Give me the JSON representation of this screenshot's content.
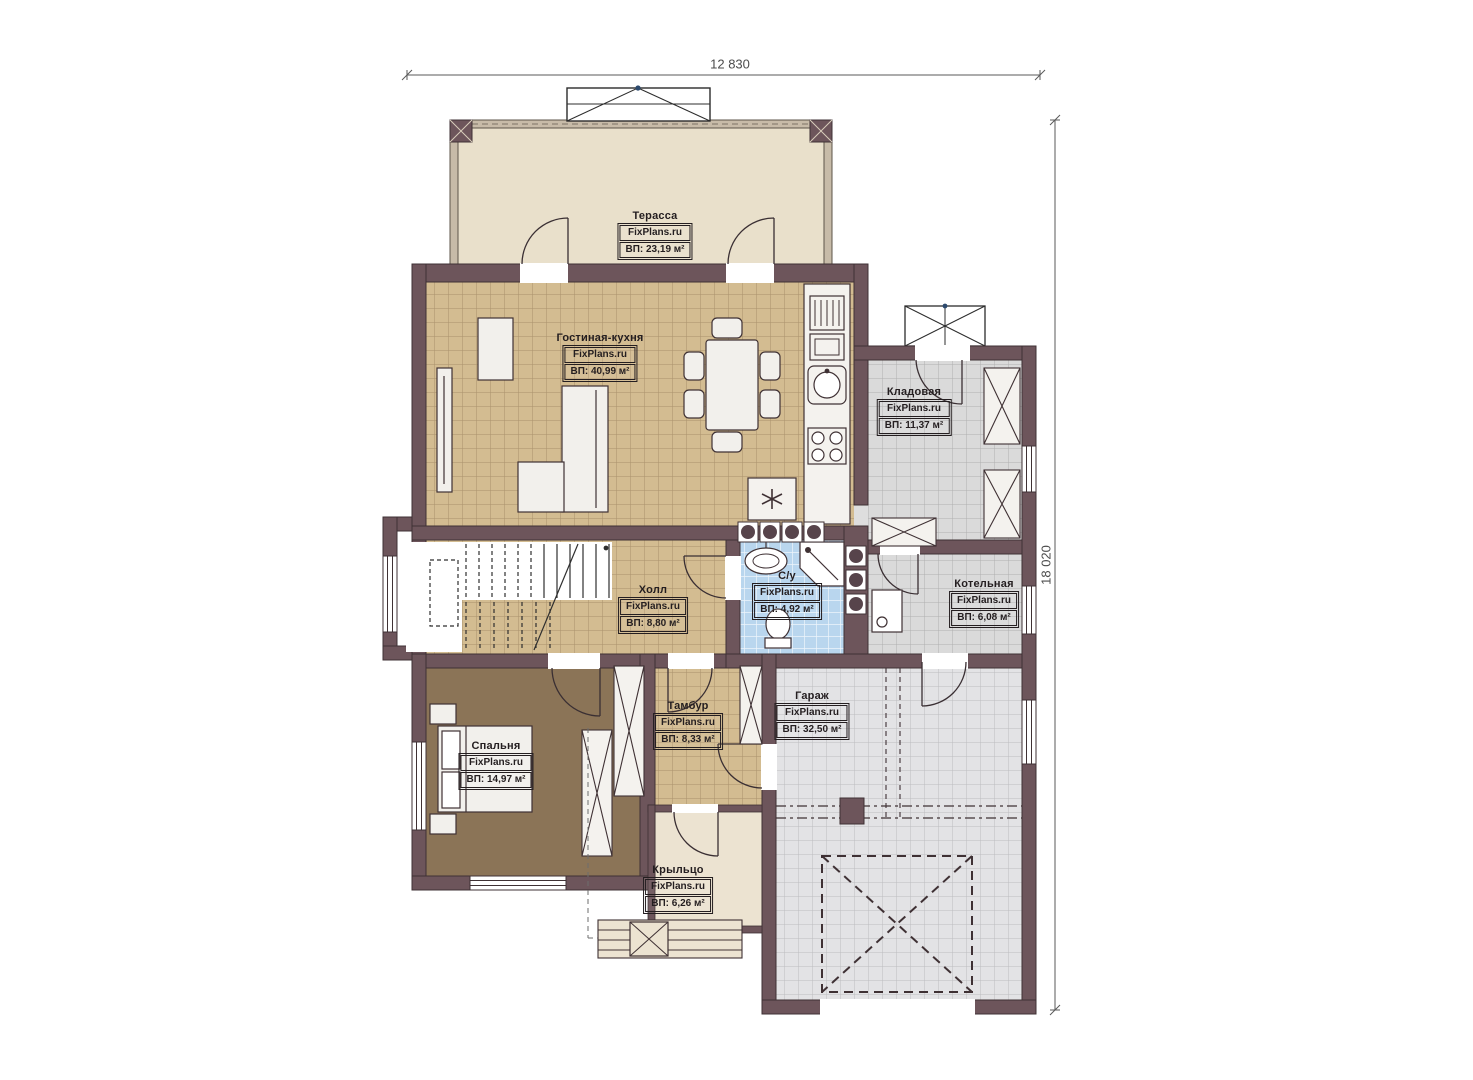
{
  "plan": {
    "type": "architectural-floor-plan",
    "overall_dimensions": {
      "width_mm": "12 830",
      "height_mm": "18 020"
    },
    "branding": {
      "site": "FixPlans.ru"
    },
    "rooms": [
      {
        "id": "terrace",
        "name": "Терасса",
        "brand": "FixPlans.ru",
        "area": "ВП: 23,19 м²"
      },
      {
        "id": "living-kitchen",
        "name": "Гостиная-кухня",
        "brand": "FixPlans.ru",
        "area": "ВП: 40,99 м²"
      },
      {
        "id": "storage",
        "name": "Кладовая",
        "brand": "FixPlans.ru",
        "area": "ВП: 11,37 м²"
      },
      {
        "id": "hall",
        "name": "Холл",
        "brand": "FixPlans.ru",
        "area": "ВП: 8,80 м²"
      },
      {
        "id": "bathroom",
        "name": "С/у",
        "brand": "FixPlans.ru",
        "area": "ВП: 4,92 м²"
      },
      {
        "id": "boiler",
        "name": "Котельная",
        "brand": "FixPlans.ru",
        "area": "ВП: 6,08 м²"
      },
      {
        "id": "vestibule",
        "name": "Тамбур",
        "brand": "FixPlans.ru",
        "area": "ВП: 8,33 м²"
      },
      {
        "id": "garage",
        "name": "Гараж",
        "brand": "FixPlans.ru",
        "area": "ВП: 32,50 м²"
      },
      {
        "id": "bedroom",
        "name": "Спальня",
        "brand": "FixPlans.ru",
        "area": "ВП: 14,97 м²"
      },
      {
        "id": "porch",
        "name": "Крыльцо",
        "brand": "FixPlans.ru",
        "area": "ВП: 6,26 м²"
      }
    ],
    "colors": {
      "wall": "#6d555b",
      "wall_outline": "#3f3134",
      "tile_tan": "#d3bc91",
      "tile_gray": "#dadada",
      "tile_garage": "#e3e3e5",
      "tile_blue": "#b9d6ee",
      "bedroom_floor": "#8b7457",
      "terrace_floor": "#e9e0cb",
      "porch_floor": "#ece3d1",
      "background": "#ffffff"
    }
  }
}
